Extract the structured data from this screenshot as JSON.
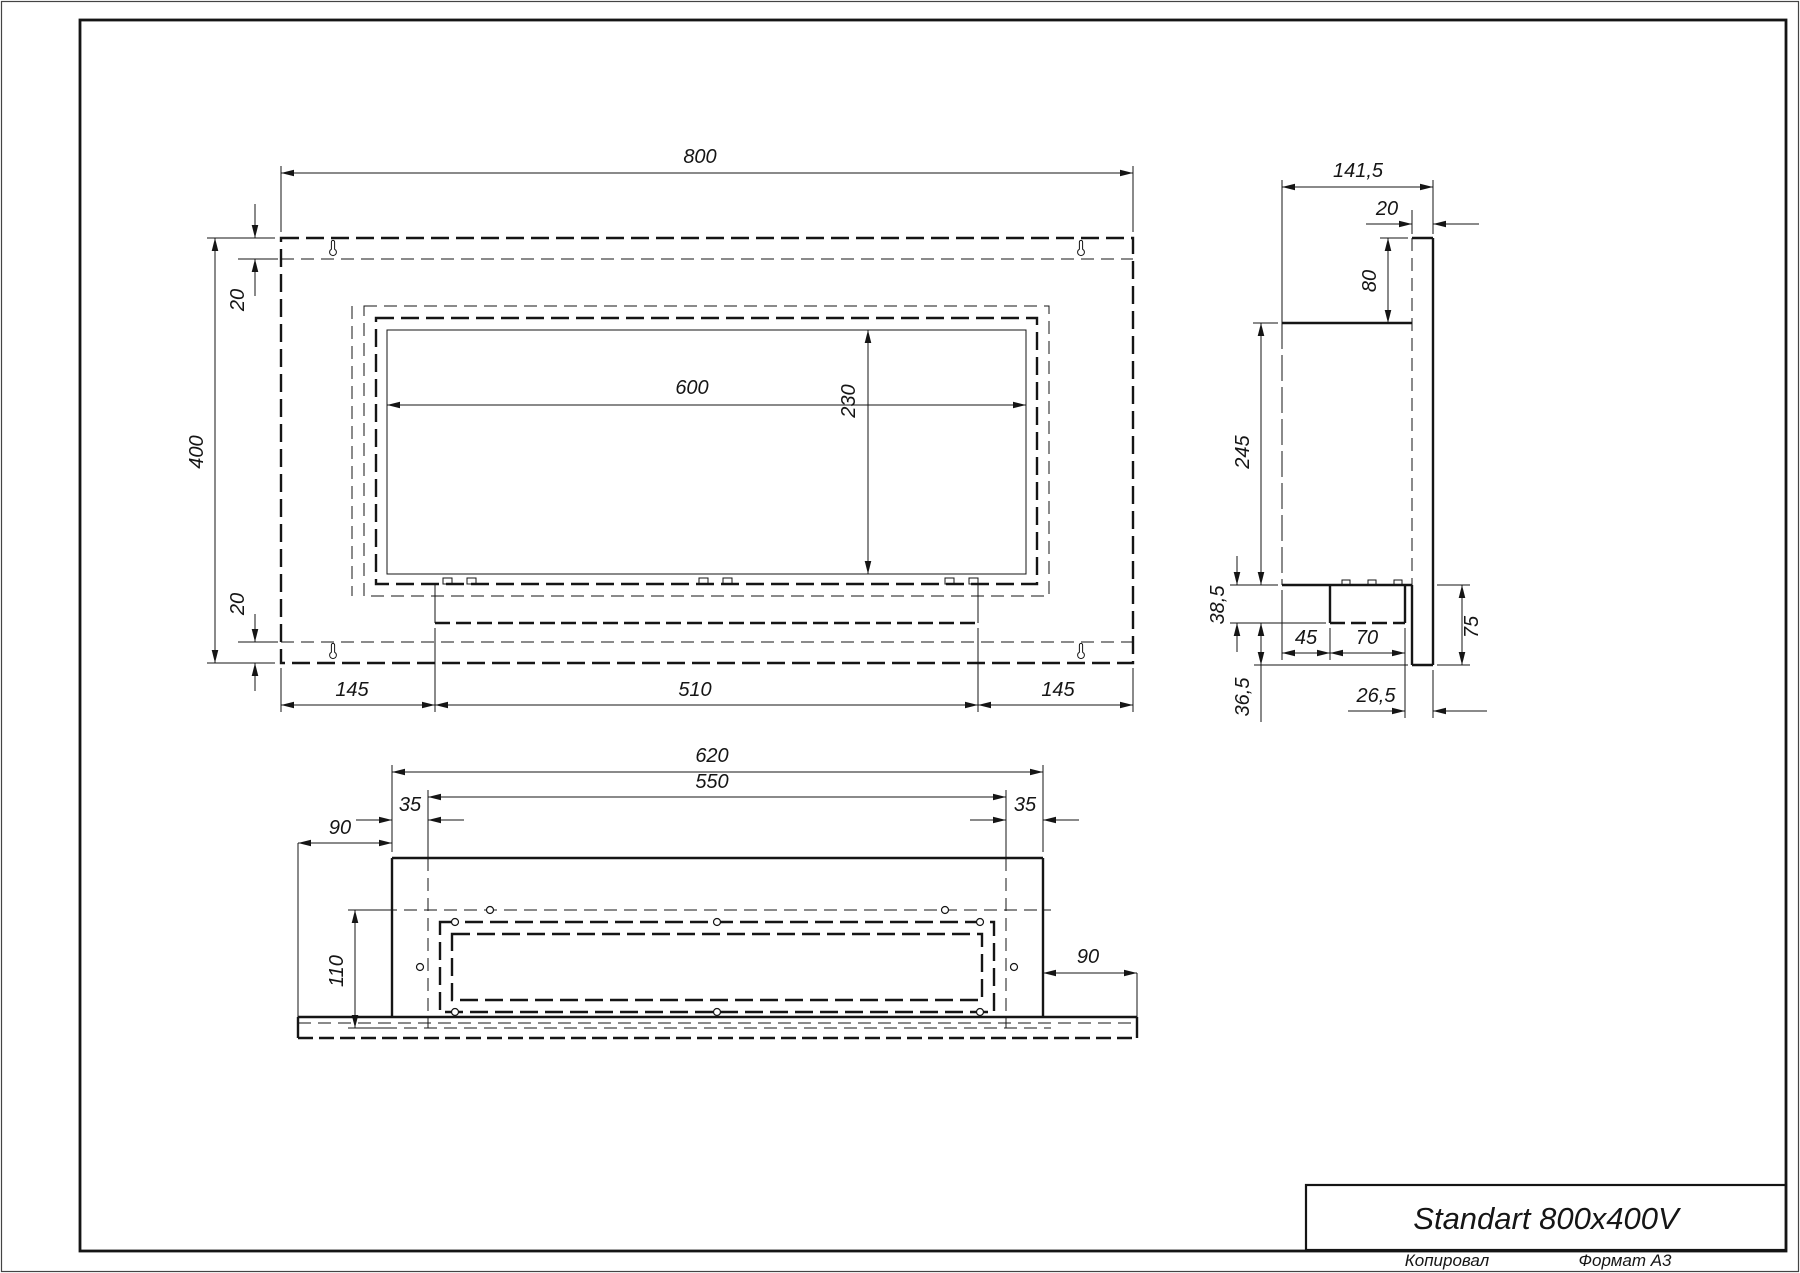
{
  "title_block": {
    "product": "Standart 800x400V",
    "footer_left": "Копировал",
    "footer_right": "Формат А3"
  },
  "front_view": {
    "width": "800",
    "height": "400",
    "margin_top": "20",
    "margin_bottom": "20",
    "opening_width": "600",
    "opening_height": "230",
    "bottom_left": "145",
    "bottom_mid": "510",
    "bottom_right": "145"
  },
  "side_view": {
    "depth": "141,5",
    "back_plate_thickness": "20",
    "back_plate_top": "80",
    "body_height": "245",
    "tray_drop": "38,5",
    "lower_drop": "36,5",
    "tray_front": "45",
    "tray_width": "70",
    "back_offset": "26,5",
    "plate_bottom": "75"
  },
  "bottom_view": {
    "body_width": "620",
    "mount_width": "550",
    "mount_margin_left": "35",
    "mount_margin_right": "35",
    "flange_left": "90",
    "depth": "110",
    "flange_right": "90"
  },
  "drawing_colors": {
    "line": "#151515",
    "paper": "#ffffff"
  }
}
